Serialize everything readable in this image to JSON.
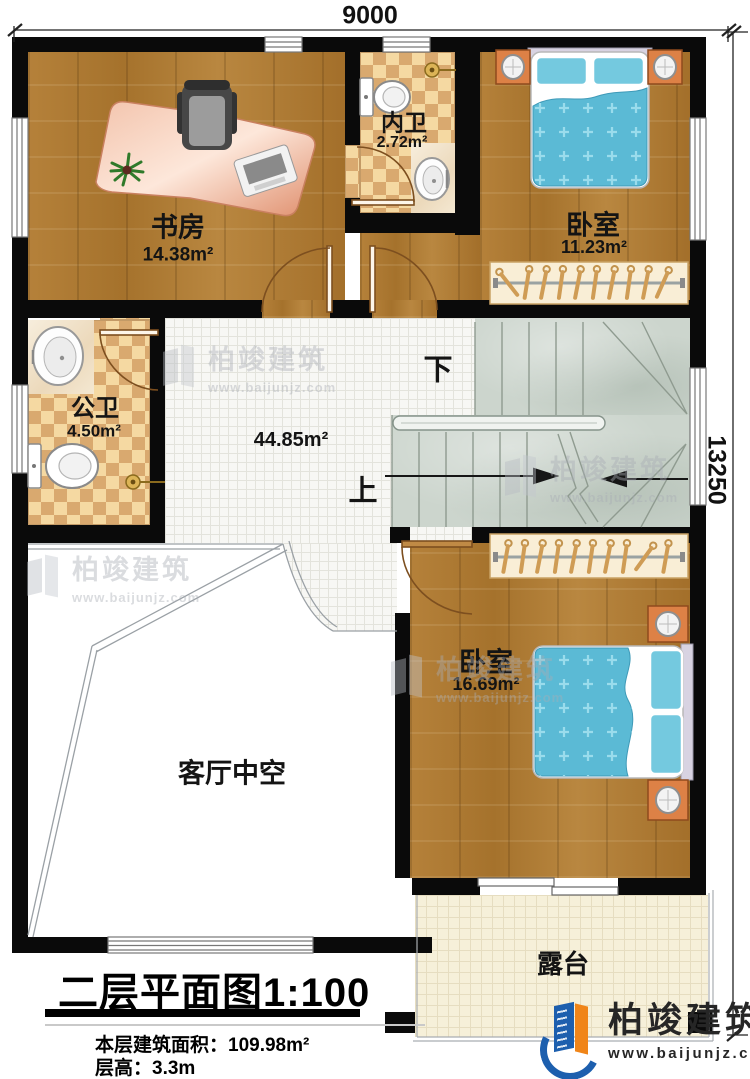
{
  "dimensions": {
    "width_top": "9000",
    "height_right": "13250"
  },
  "rooms": {
    "study": {
      "name": "书房",
      "area": "14.38m²"
    },
    "inner_bath": {
      "name": "内卫",
      "area": "2.72m²"
    },
    "bedroom_top": {
      "name": "卧室",
      "area": "11.23m²"
    },
    "public_bath": {
      "name": "公卫",
      "area": "4.50m²"
    },
    "hall": {
      "area": "44.85m²"
    },
    "bedroom_bottom": {
      "name": "卧室",
      "area": "16.69m²"
    },
    "living_void": {
      "name": "客厅中空"
    },
    "terrace": {
      "name": "露台"
    }
  },
  "stairs": {
    "down_label": "下",
    "up_label": "上"
  },
  "title_block": {
    "title": "二层平面图",
    "scale": "1:100",
    "floor_area": "本层建筑面积：109.98m²",
    "floor_height": "层高：3.3m"
  },
  "brand": {
    "name": "柏竣建筑",
    "website": "www.baijunjz.com"
  },
  "colors": {
    "wall": "#0a0a0a",
    "wood": "#ae7a31",
    "checker_light": "#f5d9a2",
    "checker_dark": "#d9a96f",
    "stair": "#ccd5cd",
    "terrace": "#f6f0d9",
    "bed_blue": "#5bbad5",
    "brand_blue": "#1d5fae",
    "brand_orange": "#f08519"
  }
}
